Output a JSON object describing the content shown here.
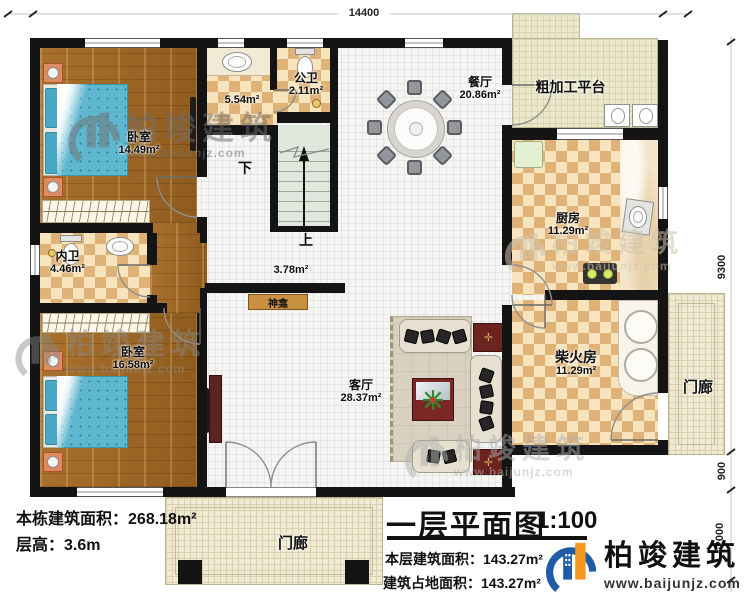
{
  "drawing": {
    "type": "floor-plan",
    "title": "一层平面图",
    "scale": "1:100"
  },
  "dims": {
    "top": "14400",
    "right_main": "9300",
    "right_porch": "900",
    "right_bottom": "2000"
  },
  "rooms": [
    {
      "id": "bedroom1",
      "name": "卧室",
      "area": "14.49m²"
    },
    {
      "id": "vanity",
      "name": "",
      "area": "5.54m²"
    },
    {
      "id": "public-bath",
      "name": "公卫",
      "area": "2.11m²"
    },
    {
      "id": "dining",
      "name": "餐厅",
      "area": "20.86m²"
    },
    {
      "id": "rough-platform",
      "name": "粗加工平台",
      "area": ""
    },
    {
      "id": "kitchen",
      "name": "厨房",
      "area": "11.29m²"
    },
    {
      "id": "private-bath",
      "name": "内卫",
      "area": "4.46m²"
    },
    {
      "id": "bedroom2",
      "name": "卧室",
      "area": "16.58m²"
    },
    {
      "id": "living",
      "name": "客厅",
      "area": "28.37m²"
    },
    {
      "id": "firewood",
      "name": "柴火房",
      "area": "11.29m²"
    },
    {
      "id": "hall",
      "name": "",
      "area": "3.78m²"
    },
    {
      "id": "porch-bottom",
      "name": "门廊",
      "area": ""
    },
    {
      "id": "porch-right",
      "name": "门廊",
      "area": ""
    },
    {
      "id": "shrine",
      "name": "神龛",
      "area": ""
    }
  ],
  "stairs": {
    "down": "下",
    "up": "上"
  },
  "info": {
    "building_total_area_label": "本栋建筑面积：",
    "building_total_area": "268.18m²",
    "floor_height_label": "层高：",
    "floor_height": "3.6m"
  },
  "titleblock": {
    "title": "一层平面图",
    "scale": "1:100",
    "floor_area_label": "本层建筑面积：",
    "floor_area": "143.27m²",
    "footprint_label": "建筑占地面积：",
    "footprint": "143.27m²"
  },
  "brand": {
    "name": "柏竣建筑",
    "website": "www.baijunjz.com"
  },
  "watermark": {
    "name": "柏竣建筑",
    "website": "www.baijunjz.com"
  },
  "colors": {
    "wall": "#141414",
    "wood_floor": "#a9712c",
    "checker_dark": "#dfb277",
    "bed_blue": "#5fb6cf",
    "logo_blue": "#1e5ca8",
    "logo_orange": "#f6991e"
  }
}
